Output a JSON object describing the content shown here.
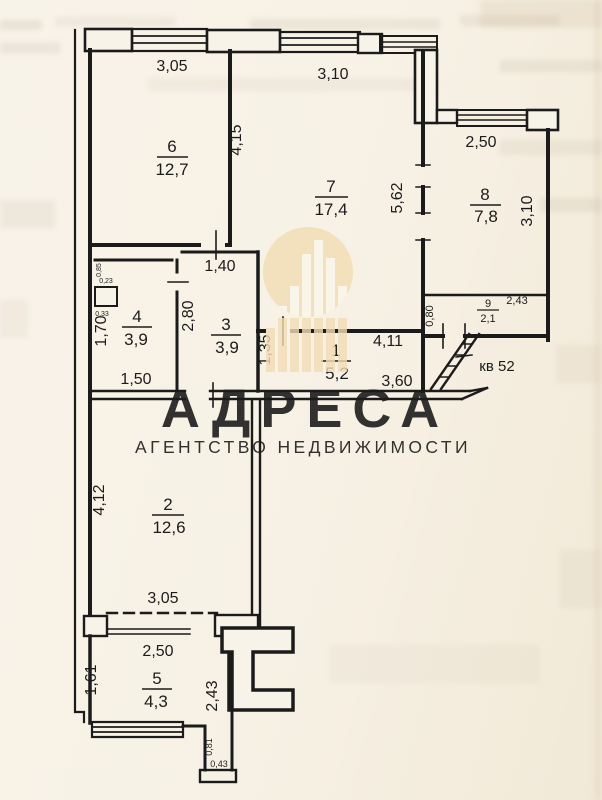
{
  "page": {
    "background": "#f7f2e7",
    "ink": "#1c1c1c"
  },
  "watermark": {
    "brand": "АДРЕСА",
    "tagline": "АГЕНТСТВО НЕДВИЖИМОСТИ",
    "logo": "building-bars-in-circle",
    "circle_color": "#f2ddb6",
    "bar_color": "#fbf7ed",
    "brand_color": "#e9cd9c",
    "tagline_color": "#e7d2aa"
  },
  "plan": {
    "apartment_label": "кв 52",
    "rooms": [
      {
        "number": "6",
        "area": "12,7"
      },
      {
        "number": "7",
        "area": "17,4"
      },
      {
        "number": "8",
        "area": "7,8"
      },
      {
        "number": "9",
        "area": "2,1"
      },
      {
        "number": "4",
        "area": "3,9"
      },
      {
        "number": "3",
        "area": "3,9"
      },
      {
        "number": "1",
        "area": "5,2"
      },
      {
        "number": "2",
        "area": "12,6"
      },
      {
        "number": "5",
        "area": "4,3"
      }
    ],
    "dimensions": {
      "room6_top": "3,05",
      "room7_top": "3,10",
      "wall_6_7": "4,15",
      "room8_top": "2,50",
      "room7_right": "5,62",
      "room8_right": "3,10",
      "room3_door": "1,40",
      "wall_3_4": "2,80",
      "room4_left": "1,70",
      "room4_bottom": "1,50",
      "room3_right": "1,35",
      "hall_top": "4,11",
      "hall_bottom": "3,60",
      "room9_left": "0,80",
      "room9_top": "2,43",
      "room2_left": "4,12",
      "room2_bottom": "3,05",
      "room5_top": "2,50",
      "room5_left": "1,61",
      "room5_right": "2,43",
      "stub_height": "0,81",
      "stub_width": "0,43",
      "vent_a": "0,85",
      "vent_b": "0,23",
      "vent_c": "0,33"
    }
  }
}
